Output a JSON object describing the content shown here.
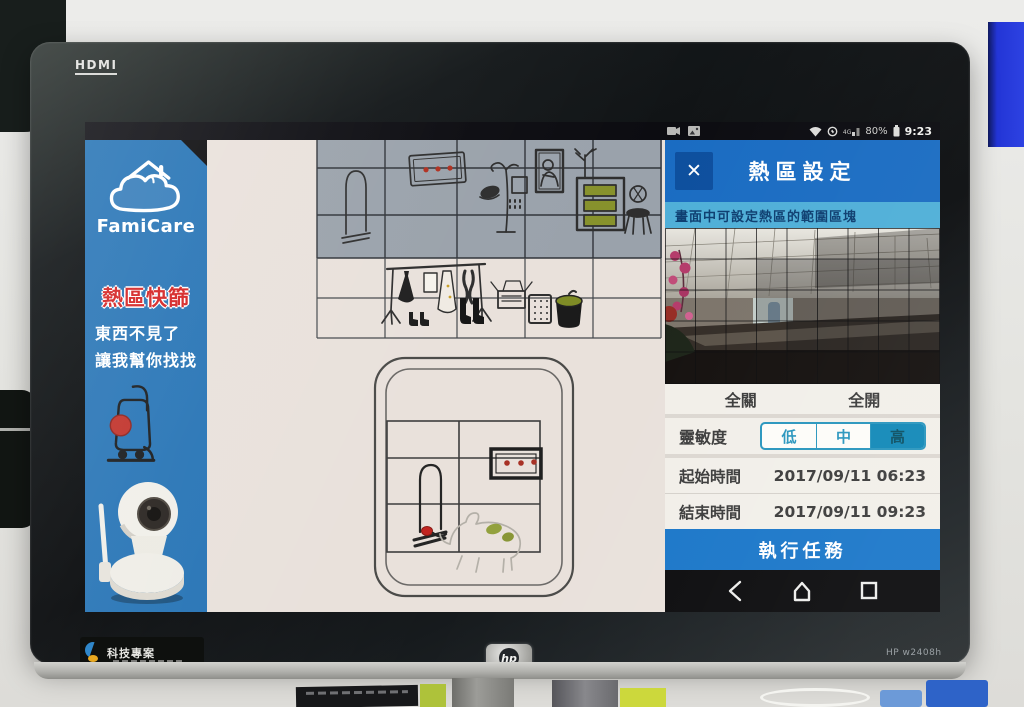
{
  "monitor": {
    "hdmi_label": "HDMI",
    "hp_logo": "hp",
    "model": "HP w2408h",
    "auto_label": "Auto",
    "sticker_title": "科技專案"
  },
  "status_bar": {
    "left_icons": [
      "camcorder-icon",
      "screenshot-icon"
    ],
    "right_icons": [
      "wifi-icon",
      "sync-icon",
      "signal-icon",
      "battery-icon"
    ],
    "network": "4G",
    "battery_pct": "80%",
    "time": "9:23"
  },
  "sidebar": {
    "logo_text": "FamiCare",
    "title": "熱區快篩",
    "line1": "東西不見了",
    "line2": "讓我幫你找找",
    "illustrations": [
      "vacuum-doodle",
      "ip-camera-product-photo"
    ]
  },
  "main_canvas": {
    "description": "hand-drawn room with hot-zone selection grid",
    "zones": [
      "wall-shelf-zone-selected-gray",
      "clothes-rack-zone",
      "rug-with-inner-grid"
    ],
    "doodles": [
      "mirror",
      "flower-frame",
      "coat-stand",
      "portrait",
      "plant-dresser",
      "chair",
      "clothes-rack",
      "boots",
      "box",
      "basket",
      "trash-can",
      "rug",
      "mirror-small",
      "flower-frame-small",
      "dog"
    ]
  },
  "panel": {
    "title": "熱區設定",
    "close_glyph": "✕",
    "instruction": "畫面中可設定熱區的範圍區塊",
    "camera_overlay": {
      "grid_cols": 9,
      "grid_rows": 5
    },
    "all_off_label": "全關",
    "all_on_label": "全開",
    "sensitivity_label": "靈敏度",
    "sensitivity_options": [
      "低",
      "中",
      "高"
    ],
    "sensitivity_selected": "高",
    "start_time_label": "起始時間",
    "start_time_value": "2017/09/11 06:23",
    "end_time_label": "結束時間",
    "end_time_value": "2017/09/11 09:23",
    "execute_label": "執行任務"
  },
  "nav_bar": {
    "icons": [
      "back-icon",
      "home-icon",
      "recents-icon"
    ]
  },
  "colors": {
    "header_blue": "#1a6cc2",
    "sidebar_blue": "#2573b5",
    "instruction_blue": "#4fafd8",
    "teal_accent": "#1289b8",
    "title_red": "#d42020",
    "execute_blue": "#1b77c9"
  }
}
